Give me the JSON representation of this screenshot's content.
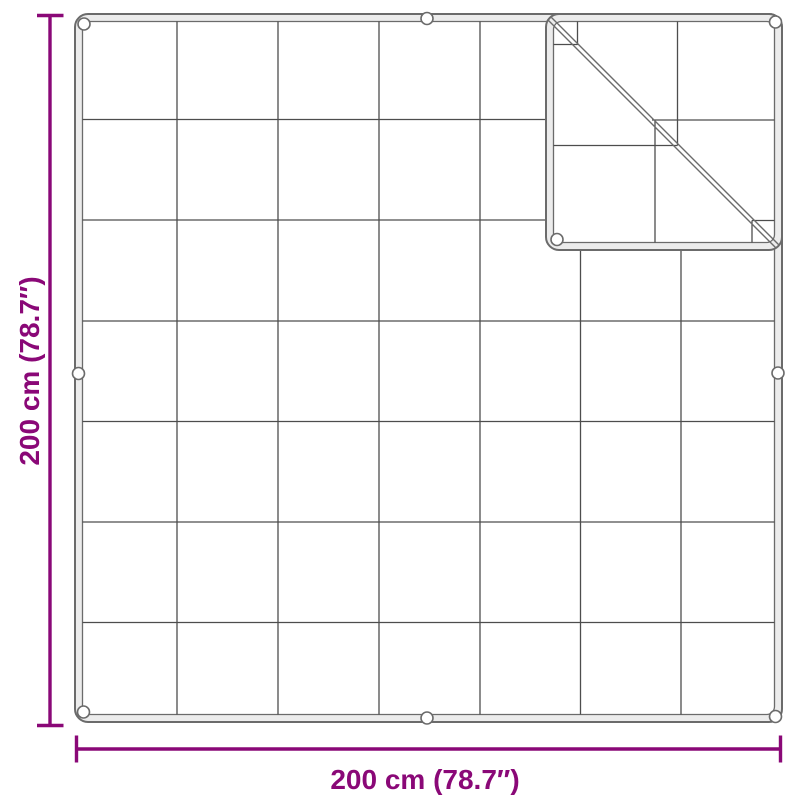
{
  "labels": {
    "width": "200 cm (78.7″)",
    "height": "200 cm (78.7″)"
  },
  "net": {
    "grid_rows": 7,
    "grid_columns": 7,
    "eyelet_count": 9,
    "folded_corner": "top-right"
  },
  "colors": {
    "accent": "#8A0877",
    "grid_line": "#4d4d4d",
    "hem_stroke": "#6b6b6b",
    "hem_fill": "#ececec",
    "background": "#ffffff"
  }
}
